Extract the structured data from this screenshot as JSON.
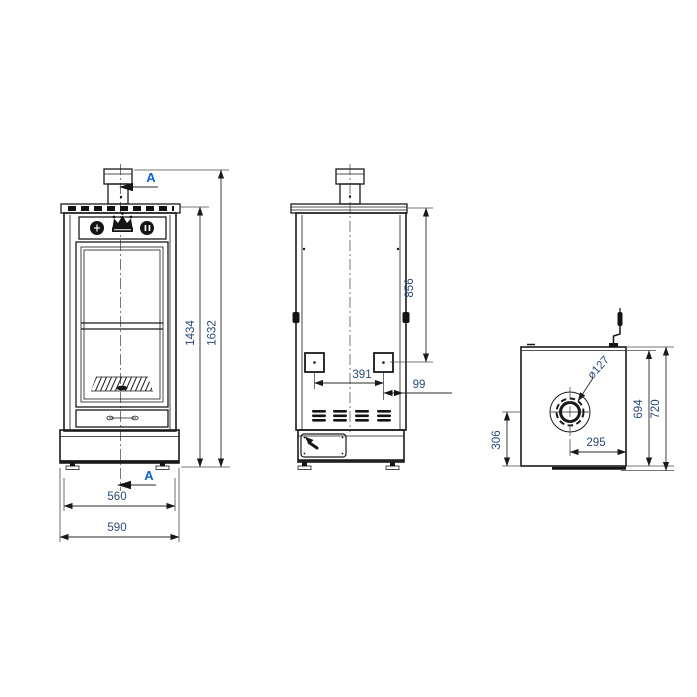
{
  "front_view": {
    "height_to_top_plate": "1434",
    "overall_height": "1632",
    "body_width": "560",
    "base_width": "590",
    "section_marker_top": "A",
    "section_marker_bottom": "A"
  },
  "side_view": {
    "top_plate_to_port": "856",
    "port_spacing": "391",
    "port_to_rear": "99"
  },
  "top_view": {
    "flue_diameter": "ø127",
    "flue_center_to_rear": "295",
    "flue_center_to_side": "306",
    "top_plate_depth": "694",
    "overall_depth": "720"
  },
  "colors": {
    "line": "#1a1a1a",
    "dimension_text": "#2b4a77",
    "section_text": "#0f62c4",
    "background": "#ffffff"
  }
}
